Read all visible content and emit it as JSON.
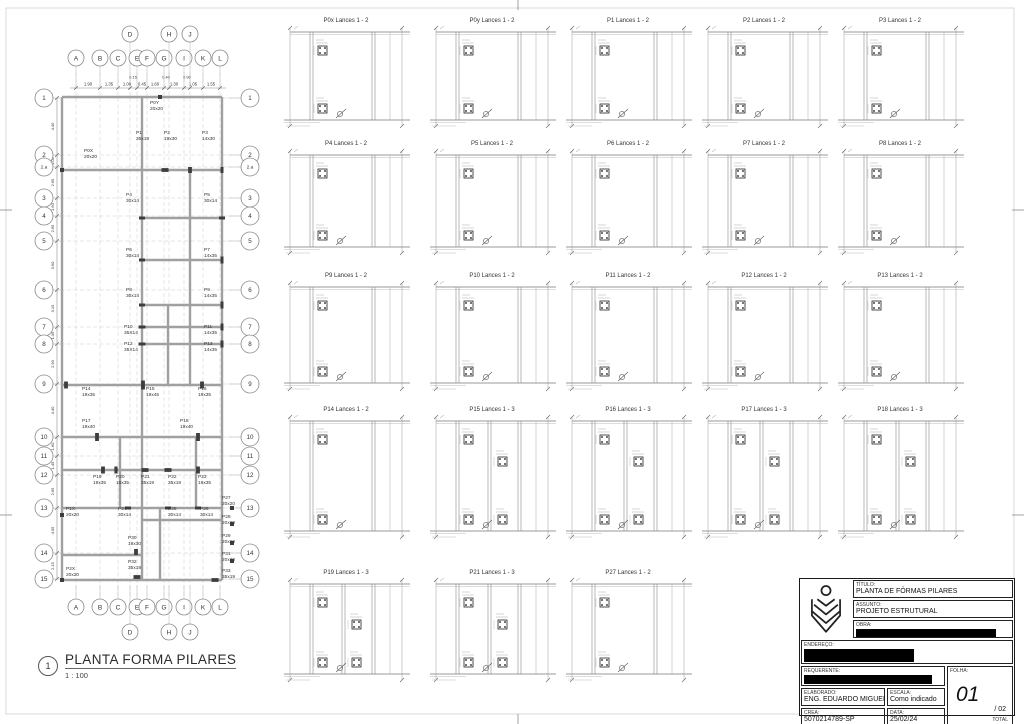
{
  "sheet": {
    "plan_title": {
      "number": "1",
      "title": "PLANTA FORMA PILARES",
      "scale": "1 : 100"
    },
    "titleblock": {
      "titulo_label": "TÍTULO:",
      "titulo": "PLANTA DE FÔRMAS PILARES",
      "assunto_label": "ASSUNTO:",
      "assunto": "PROJETO ESTRUTURAL",
      "obra_label": "OBRA:",
      "endereco_label": "ENDEREÇO:",
      "requerente_label": "REQUERENTE:",
      "elaborado_label": "ELABORADO:",
      "elaborado": "ENG. EDUARDO MIGUEL",
      "escala_label": "ESCALA:",
      "escala": "Como indicado",
      "crea_label": "CREA:",
      "crea": "5070214789-SP",
      "data_label": "DATA:",
      "data": "25/02/24",
      "folha_label": "FOLHA:",
      "folha": "01",
      "folha_of": "/ 02",
      "total_label": "TOTAL"
    }
  },
  "colors": {
    "wall": "#a0a0a0",
    "grid": "#c9c9c9",
    "line": "#777777",
    "column": "#3d3d3d",
    "ink": "#333333"
  },
  "plan": {
    "col_grids": [
      {
        "label": "A",
        "x": 76,
        "offset": false
      },
      {
        "label": "B",
        "x": 100,
        "offset": false
      },
      {
        "label": "C",
        "x": 118,
        "offset": false
      },
      {
        "label": "D",
        "x": 130,
        "offset": true
      },
      {
        "label": "E",
        "x": 137,
        "offset": false
      },
      {
        "label": "F",
        "x": 147,
        "offset": false
      },
      {
        "label": "G",
        "x": 164,
        "offset": false
      },
      {
        "label": "H",
        "x": 169,
        "offset": true
      },
      {
        "label": "I",
        "x": 184,
        "offset": false
      },
      {
        "label": "J",
        "x": 190,
        "offset": true
      },
      {
        "label": "K",
        "x": 203,
        "offset": false
      },
      {
        "label": "L",
        "x": 220,
        "offset": false
      }
    ],
    "row_grids": [
      {
        "label": "1",
        "y": 98
      },
      {
        "label": "2",
        "y": 155
      },
      {
        "label": "2.a",
        "y": 167
      },
      {
        "label": "3",
        "y": 198
      },
      {
        "label": "4",
        "y": 216
      },
      {
        "label": "5",
        "y": 241
      },
      {
        "label": "6",
        "y": 290
      },
      {
        "label": "7",
        "y": 327
      },
      {
        "label": "8",
        "y": 344
      },
      {
        "label": "9",
        "y": 384
      },
      {
        "label": "10",
        "y": 437
      },
      {
        "label": "11",
        "y": 456
      },
      {
        "label": "12",
        "y": 475
      },
      {
        "label": "13",
        "y": 508
      },
      {
        "label": "14",
        "y": 553
      },
      {
        "label": "15",
        "y": 579
      }
    ],
    "row_dims": [
      "4.40",
      "1.05",
      "2.65",
      "1.60",
      "2.65",
      "3.60",
      "3.15",
      "1.35",
      "2.90",
      "4.40",
      "1.60",
      "1.45",
      "2.65",
      "4.05",
      "2.15"
    ],
    "top_dims": [
      {
        "v": "1.90",
        "x": 88
      },
      {
        "v": "1.35",
        "x": 109
      },
      {
        "v": "1.00",
        "x": 127
      },
      {
        "v": "0.45",
        "x": 142
      },
      {
        "v": "1.60",
        "x": 155
      },
      {
        "v": "1.30",
        "x": 174
      },
      {
        "v": "1.05",
        "x": 193
      },
      {
        "v": "1.55",
        "x": 211
      }
    ],
    "top_dims_small": [
      {
        "v": "0.15",
        "x": 133
      },
      {
        "v": "0.40",
        "x": 166
      },
      {
        "v": "0.90",
        "x": 187
      }
    ],
    "walls_h": [
      [
        97,
        62,
        222
      ],
      [
        170,
        62,
        222
      ],
      [
        218,
        142,
        222
      ],
      [
        260,
        142,
        222
      ],
      [
        305,
        142,
        222
      ],
      [
        327,
        142,
        222
      ],
      [
        344,
        142,
        222
      ],
      [
        385,
        62,
        222
      ],
      [
        437,
        62,
        222
      ],
      [
        470,
        62,
        222
      ],
      [
        508,
        62,
        222
      ],
      [
        520,
        142,
        222
      ],
      [
        555,
        62,
        142
      ],
      [
        580,
        62,
        222
      ]
    ],
    "walls_v": [
      [
        62,
        97,
        580
      ],
      [
        142,
        97,
        580
      ],
      [
        222,
        97,
        580
      ],
      [
        190,
        170,
        385
      ],
      [
        168,
        305,
        385
      ],
      [
        120,
        437,
        508
      ],
      [
        196,
        437,
        508
      ],
      [
        160,
        508,
        580
      ]
    ],
    "columns": [
      {
        "name": "P0Y",
        "size": "20x20",
        "lx": 150,
        "ly": 104,
        "cx": 160,
        "cy": 97
      },
      {
        "name": "P0X",
        "size": "20x20",
        "lx": 84,
        "ly": 152,
        "cx": 62,
        "cy": 170
      },
      {
        "name": "P1",
        "size": "35x19",
        "lx": 136,
        "ly": 134,
        "cx": 165,
        "cy": 170
      },
      {
        "name": "P2",
        "size": "19x30",
        "lx": 164,
        "ly": 134,
        "cx": 190,
        "cy": 170
      },
      {
        "name": "P3",
        "size": "14x30",
        "lx": 202,
        "ly": 134,
        "cx": 222,
        "cy": 170
      },
      {
        "name": "P4",
        "size": "30x14",
        "lx": 126,
        "ly": 196,
        "cx": 142,
        "cy": 218
      },
      {
        "name": "P5",
        "size": "30x14",
        "lx": 204,
        "ly": 196,
        "cx": 222,
        "cy": 218
      },
      {
        "name": "P6",
        "size": "30x14",
        "lx": 126,
        "ly": 251,
        "cx": 142,
        "cy": 260
      },
      {
        "name": "P7",
        "size": "14x35",
        "lx": 204,
        "ly": 251,
        "cx": 222,
        "cy": 260
      },
      {
        "name": "P8",
        "size": "30x14",
        "lx": 126,
        "ly": 291,
        "cx": 142,
        "cy": 305
      },
      {
        "name": "P9",
        "size": "14x35",
        "lx": 204,
        "ly": 291,
        "cx": 222,
        "cy": 305
      },
      {
        "name": "P10",
        "size": "35X14",
        "lx": 124,
        "ly": 328,
        "cx": 142,
        "cy": 327
      },
      {
        "name": "P11",
        "size": "14x35",
        "lx": 204,
        "ly": 328,
        "cx": 222,
        "cy": 327
      },
      {
        "name": "P12",
        "size": "35X14",
        "lx": 124,
        "ly": 345,
        "cx": 142,
        "cy": 344
      },
      {
        "name": "P13",
        "size": "14x35",
        "lx": 204,
        "ly": 345,
        "cx": 222,
        "cy": 344
      },
      {
        "name": "P14",
        "size": "19x35",
        "lx": 82,
        "ly": 390,
        "cx": 66,
        "cy": 385
      },
      {
        "name": "P15",
        "size": "19x45",
        "lx": 146,
        "ly": 390,
        "cx": 143,
        "cy": 385
      },
      {
        "name": "P16",
        "size": "19x35",
        "lx": 198,
        "ly": 390,
        "cx": 202,
        "cy": 385
      },
      {
        "name": "P17",
        "size": "19x40",
        "lx": 82,
        "ly": 422,
        "cx": 97,
        "cy": 437
      },
      {
        "name": "P18",
        "size": "19x40",
        "lx": 180,
        "ly": 422,
        "cx": 198,
        "cy": 437
      },
      {
        "name": "P19",
        "size": "19x35",
        "lx": 93,
        "ly": 478,
        "cx": 103,
        "cy": 470
      },
      {
        "name": "P20",
        "size": "16x35",
        "lx": 116,
        "ly": 478,
        "cx": 116,
        "cy": 470
      },
      {
        "name": "P21",
        "size": "35x19",
        "lx": 141,
        "ly": 478,
        "cx": 145,
        "cy": 470
      },
      {
        "name": "P22",
        "size": "35x19",
        "lx": 168,
        "ly": 478,
        "cx": 168,
        "cy": 470
      },
      {
        "name": "P23",
        "size": "19x35",
        "lx": 198,
        "ly": 478,
        "cx": 198,
        "cy": 470
      },
      {
        "name": "P27",
        "size": "20x20",
        "lx": 222,
        "ly": 499,
        "cx": 232,
        "cy": 508
      },
      {
        "name": "P1X",
        "size": "20x20",
        "lx": 66,
        "ly": 510,
        "cx": 62,
        "cy": 515
      },
      {
        "name": "P24",
        "size": "30x14",
        "lx": 118,
        "ly": 510,
        "cx": 128,
        "cy": 508
      },
      {
        "name": "P25",
        "size": "30x14",
        "lx": 168,
        "ly": 510,
        "cx": 168,
        "cy": 508
      },
      {
        "name": "P26",
        "size": "30x14",
        "lx": 200,
        "ly": 510,
        "cx": 198,
        "cy": 508
      },
      {
        "name": "P28",
        "size": "20x20",
        "lx": 222,
        "ly": 518,
        "cx": 232,
        "cy": 524
      },
      {
        "name": "P29",
        "size": "20x20",
        "lx": 222,
        "ly": 537,
        "cx": 232,
        "cy": 543
      },
      {
        "name": "P30",
        "size": "19x30",
        "lx": 128,
        "ly": 539,
        "cx": 136,
        "cy": 552
      },
      {
        "name": "P31",
        "size": "20x20",
        "lx": 222,
        "ly": 555,
        "cx": 232,
        "cy": 561
      },
      {
        "name": "P32",
        "size": "35x19",
        "lx": 128,
        "ly": 563,
        "cx": 137,
        "cy": 577
      },
      {
        "name": "P2X",
        "size": "20x20",
        "lx": 66,
        "ly": 570,
        "cx": 62,
        "cy": 580
      },
      {
        "name": "P33",
        "size": "35x19",
        "lx": 222,
        "ly": 572,
        "cx": 215,
        "cy": 580
      }
    ]
  },
  "panels": {
    "cols_x": [
      280,
      426,
      562,
      698,
      834
    ],
    "rows": [
      {
        "ty": 17,
        "py": 26,
        "h": 104
      },
      {
        "ty": 140,
        "py": 149,
        "h": 108
      },
      {
        "ty": 272,
        "py": 281,
        "h": 112
      },
      {
        "ty": 406,
        "py": 415,
        "h": 126
      },
      {
        "ty": 569,
        "py": 578,
        "h": 106
      }
    ],
    "w": 132,
    "items": [
      {
        "title": "P0x Lances 1 - 2",
        "row": 0,
        "col": 0,
        "lances": 2
      },
      {
        "title": "P0y Lances 1 - 2",
        "row": 0,
        "col": 1,
        "lances": 2
      },
      {
        "title": "P1 Lances 1 - 2",
        "row": 0,
        "col": 2,
        "lances": 2
      },
      {
        "title": "P2 Lances 1 - 2",
        "row": 0,
        "col": 3,
        "lances": 2
      },
      {
        "title": "P3 Lances 1 - 2",
        "row": 0,
        "col": 4,
        "lances": 2
      },
      {
        "title": "P4 Lances 1 - 2",
        "row": 1,
        "col": 0,
        "lances": 2
      },
      {
        "title": "P5 Lances 1 - 2",
        "row": 1,
        "col": 1,
        "lances": 2
      },
      {
        "title": "P6 Lances 1 - 2",
        "row": 1,
        "col": 2,
        "lances": 2
      },
      {
        "title": "P7 Lances 1 - 2",
        "row": 1,
        "col": 3,
        "lances": 2
      },
      {
        "title": "P8 Lances 1 - 2",
        "row": 1,
        "col": 4,
        "lances": 2
      },
      {
        "title": "P9 Lances 1 - 2",
        "row": 2,
        "col": 0,
        "lances": 2
      },
      {
        "title": "P10 Lances 1 - 2",
        "row": 2,
        "col": 1,
        "lances": 2
      },
      {
        "title": "P11 Lances 1 - 2",
        "row": 2,
        "col": 2,
        "lances": 2
      },
      {
        "title": "P12 Lances 1 - 2",
        "row": 2,
        "col": 3,
        "lances": 2
      },
      {
        "title": "P13 Lances 1 - 2",
        "row": 2,
        "col": 4,
        "lances": 2
      },
      {
        "title": "P14 Lances 1 - 2",
        "row": 3,
        "col": 0,
        "lances": 2
      },
      {
        "title": "P15 Lances 1 - 3",
        "row": 3,
        "col": 1,
        "lances": 3
      },
      {
        "title": "P16 Lances 1 - 3",
        "row": 3,
        "col": 2,
        "lances": 3
      },
      {
        "title": "P17 Lances 1 - 3",
        "row": 3,
        "col": 3,
        "lances": 3
      },
      {
        "title": "P18 Lances 1 - 3",
        "row": 3,
        "col": 4,
        "lances": 3
      },
      {
        "title": "P19 Lances 1 - 3",
        "row": 4,
        "col": 0,
        "lances": 3
      },
      {
        "title": "P21 Lances 1 - 3",
        "row": 4,
        "col": 1,
        "lances": 3
      },
      {
        "title": "P27 Lances 1 - 2",
        "row": 4,
        "col": 2,
        "lances": 2
      }
    ]
  }
}
